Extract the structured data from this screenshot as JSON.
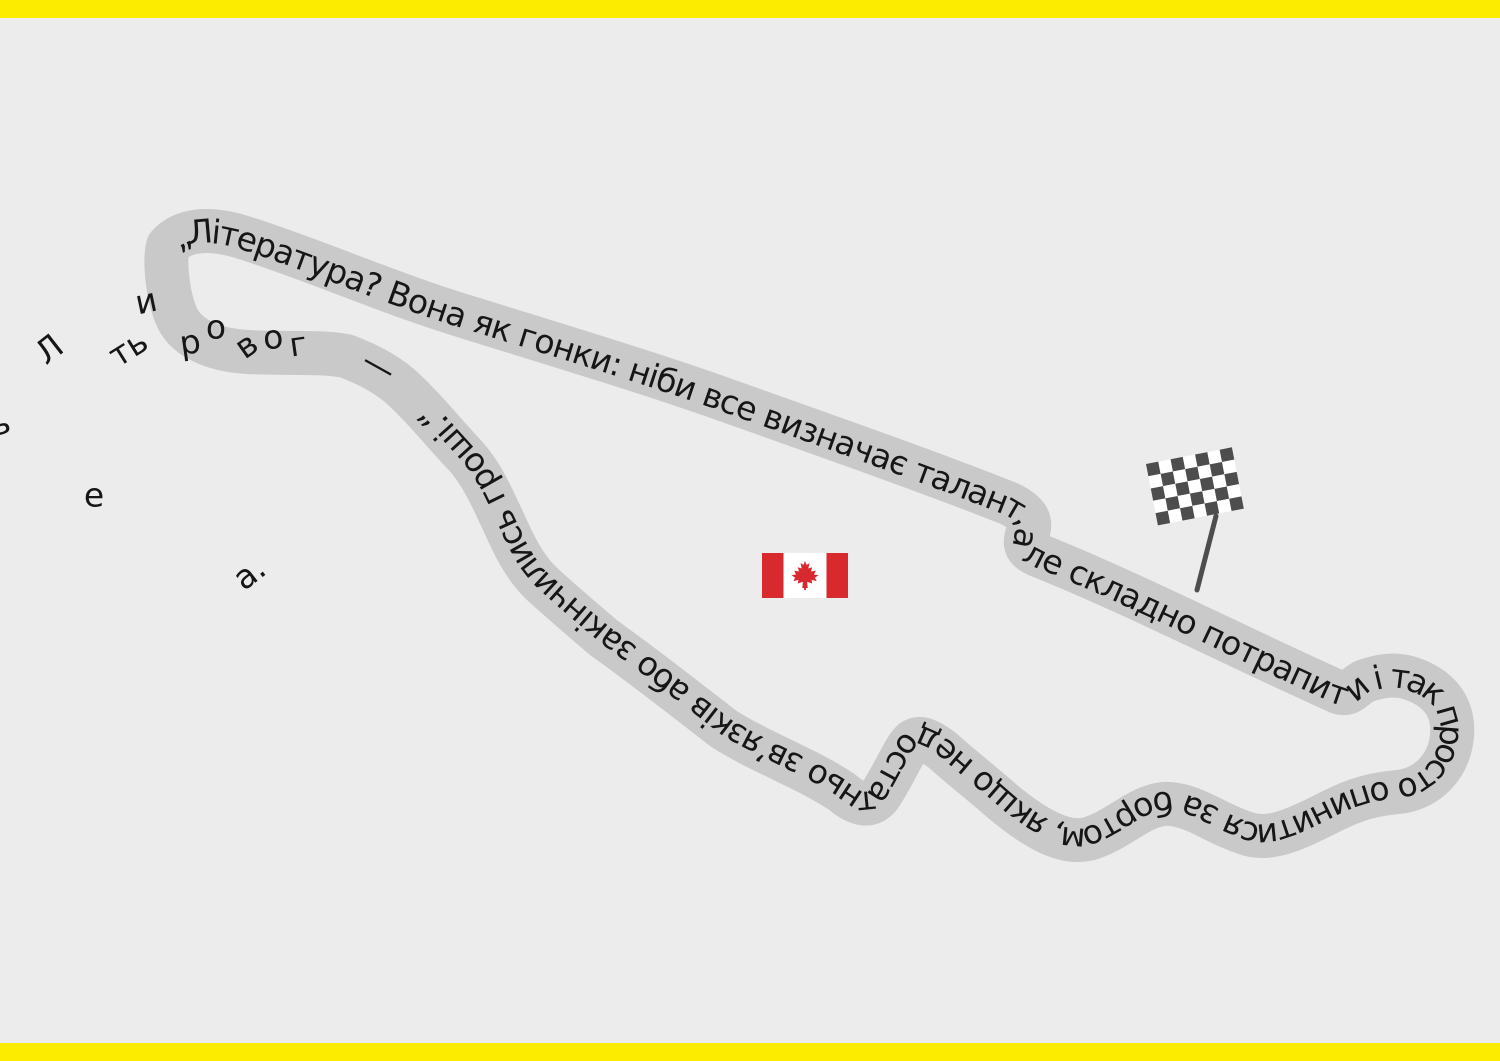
{
  "canvas": {
    "width": 1500,
    "height": 1061
  },
  "colors": {
    "background": "#ececec",
    "accent_bar": "#fbec00",
    "track": "#c9c9c9",
    "text": "#161616",
    "flag_red": "#d8292f",
    "flag_white": "#ffffff",
    "checker_dark": "#4d4d4d",
    "pole": "#4d4d4d"
  },
  "track": {
    "quote": "„Література? Вона як гонки: ніби все визначає талант, але складно потрапити і так просто опинитися за бортом, якщо недостатньо зв’язків або закінчились гроші.“",
    "dash": "—"
  },
  "scattered_letters": [
    {
      "ch": "ь",
      "x": 0,
      "y": 423,
      "rot": -15
    },
    {
      "ch": "Л",
      "x": 49,
      "y": 349,
      "rot": -38
    },
    {
      "ch": "и",
      "x": 146,
      "y": 301,
      "rot": -12
    },
    {
      "ch": "ть",
      "x": 128,
      "y": 348,
      "rot": -32
    },
    {
      "ch": "р",
      "x": 190,
      "y": 342,
      "rot": -8
    },
    {
      "ch": "о",
      "x": 216,
      "y": 327,
      "rot": 0
    },
    {
      "ch": "в",
      "x": 246,
      "y": 345,
      "rot": -35
    },
    {
      "ch": "о",
      "x": 273,
      "y": 337,
      "rot": -5
    },
    {
      "ch": "г",
      "x": 298,
      "y": 344,
      "rot": -8
    },
    {
      "ch": "е",
      "x": 94,
      "y": 495,
      "rot": 0
    },
    {
      "ch": "а.",
      "x": 249,
      "y": 573,
      "rot": -38
    }
  ],
  "icons": {
    "canada_flag": "canada-flag-icon",
    "checkered_flag": "checkered-flag-icon"
  }
}
